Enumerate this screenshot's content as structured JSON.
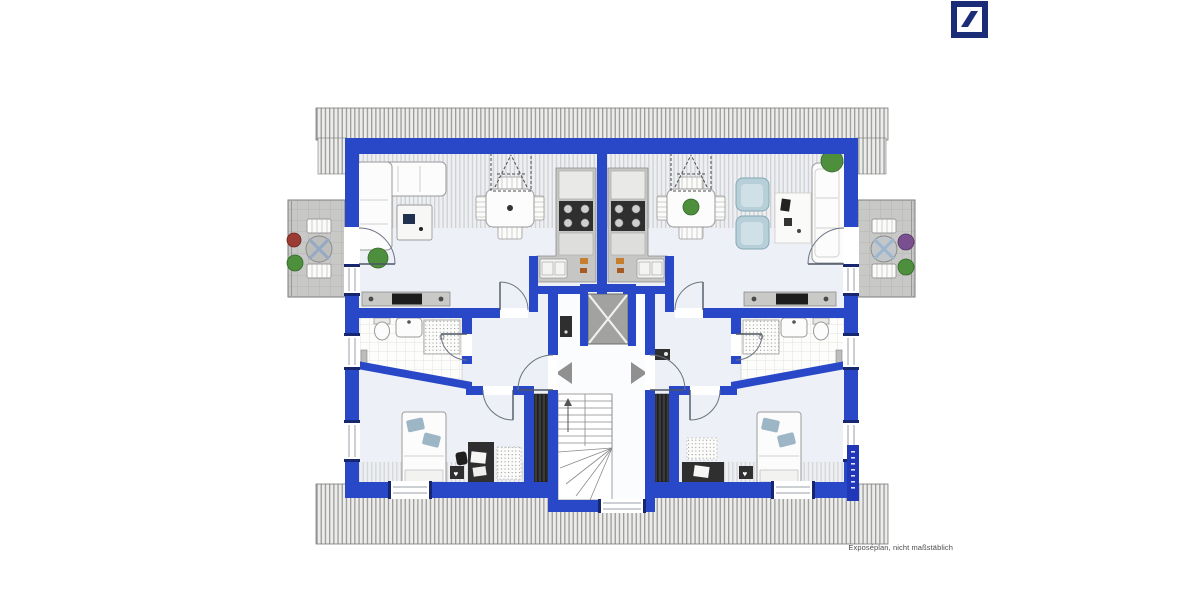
{
  "branding": {
    "logo_icon": "deutsche-bank-slash-logo"
  },
  "caption": {
    "text": "Exposéplan, nicht maßstäblich"
  },
  "icons": {
    "heart": "♥"
  },
  "palette": {
    "wall_blue": "#2948c8",
    "wall_navy": "#17276f",
    "logo_navy": "#1c2d78",
    "roof_bg": "#ececea",
    "roof_line": "#9b9b99",
    "floor": "#edf1f7",
    "balcony_tile": "#c8c8c6",
    "counter_grey": "#c6c6c4",
    "appliance_dark": "#2f2f2f",
    "armchair_blue": "#b7cfd8",
    "pillow_blue": "#9db6c6",
    "elevator_grey": "#a2a2a0",
    "arrow_grey": "#909090",
    "plant_green": "#4e8f3e",
    "plant_red": "#9c3b34",
    "plant_purple": "#7a4f8f",
    "caption_grey": "#4c4c4c"
  },
  "floorplan": {
    "type": "residential-attic-floor-two-mirrored-apartments",
    "symbols": [
      "roof-hatching",
      "balcony-left",
      "balcony-right",
      "corner-sofa",
      "coffee-table",
      "dining-table-with-4-chairs",
      "roof-window-dashed",
      "kitchen-counter",
      "tv-sideboard",
      "bathroom-tiled",
      "shower",
      "washbasin",
      "toilet",
      "bed",
      "desk",
      "laundry-bench",
      "rug",
      "armchairs",
      "sofa",
      "plants",
      "elevator",
      "winding-staircase",
      "entrance-arrows",
      "apartment-entry-doors"
    ]
  }
}
